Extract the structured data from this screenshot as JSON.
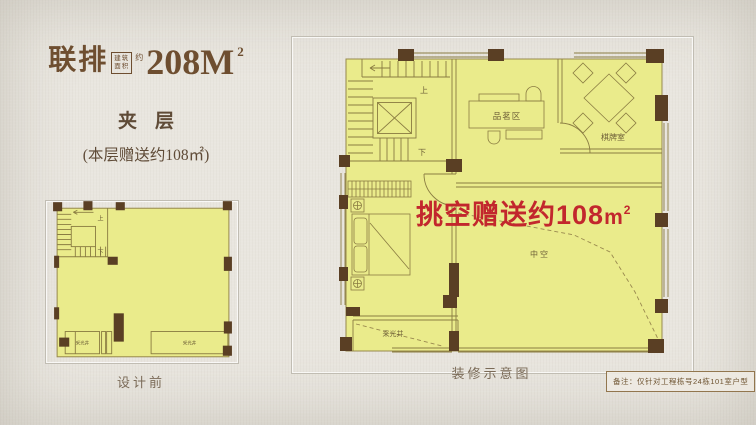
{
  "colors": {
    "background": "#e9e6df",
    "plan_fill": "#eaeb8b",
    "wall_brown": "#5a3f24",
    "plan_line": "#8a7c42",
    "title_brown": "#6e4e30",
    "highlight_red": "#c2272d",
    "caption_gray": "#7b6b58"
  },
  "header": {
    "type_label": "联排",
    "area_box_line1": "建筑",
    "area_box_line2": "面积",
    "area_about": "约",
    "area_value": "208M",
    "area_sup": "2",
    "floor_title": "夹层",
    "floor_note": "(本层赠送约108㎡)"
  },
  "left_plan": {
    "caption": "设计前",
    "label_up": "上",
    "label_down": "下",
    "label_lightwell_left": "采光井",
    "label_lightwell_right": "采光井"
  },
  "right_plan": {
    "caption": "装修示意图",
    "label_up": "上",
    "label_down": "下",
    "label_tea_area": "品茗区",
    "label_chess_room": "棋牌室",
    "label_void": "中空",
    "label_lightwell": "采光井",
    "highlight_text": "挑空赠送约108",
    "highlight_unit": "m",
    "highlight_sup": "2"
  },
  "footnote": "备注：仅针对工程栋号24栋101室户型"
}
